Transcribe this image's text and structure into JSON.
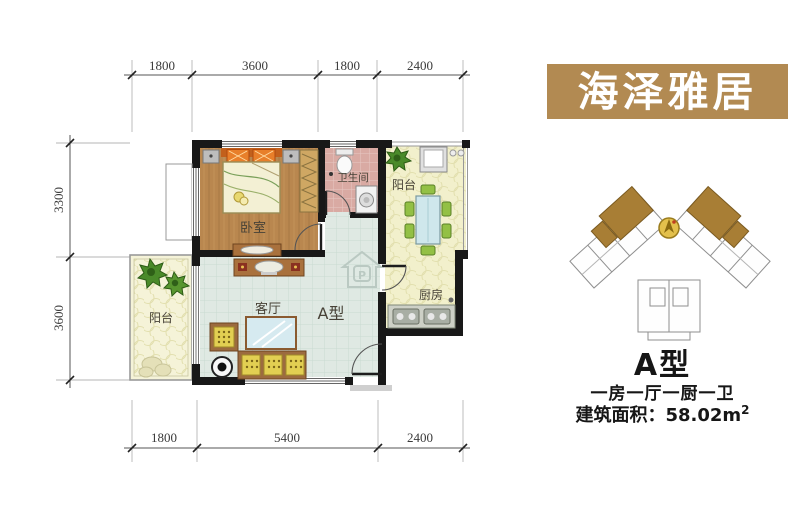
{
  "banner": {
    "text": "海泽雅居",
    "bg": "#b28a52",
    "fg": "#ffffff"
  },
  "plan": {
    "rooms": {
      "bedroom": "卧室",
      "bathroom": "卫生间",
      "balcony_top": "阳台",
      "kitchen": "厨房",
      "living": "客厅",
      "unit_label": "A型",
      "balcony_left": "阳台"
    },
    "dims": {
      "top": [
        "1800",
        "3600",
        "1800",
        "2400"
      ],
      "left": [
        "3300",
        "3600"
      ],
      "bottom": [
        "1800",
        "5400",
        "2400"
      ]
    },
    "watermark_letter": "P"
  },
  "info": {
    "type": "A型",
    "layout": "一房一厅一厨一卫",
    "area_text": "建筑面积：58.02m",
    "area_sup": "2"
  },
  "colors": {
    "banner_bg": "#b28a52",
    "wall": "#181818",
    "bedroom_floor": "#b9874f",
    "bathroom_floor": "#d9aaa3",
    "living_floor": "#dfe9e3",
    "balcony_floor": "#f2f0cc",
    "wood_accent": "#a9713d",
    "sofa_cushion": "#e2cf52",
    "chair_green": "#93c045",
    "table_blue": "#cfe7ec"
  }
}
